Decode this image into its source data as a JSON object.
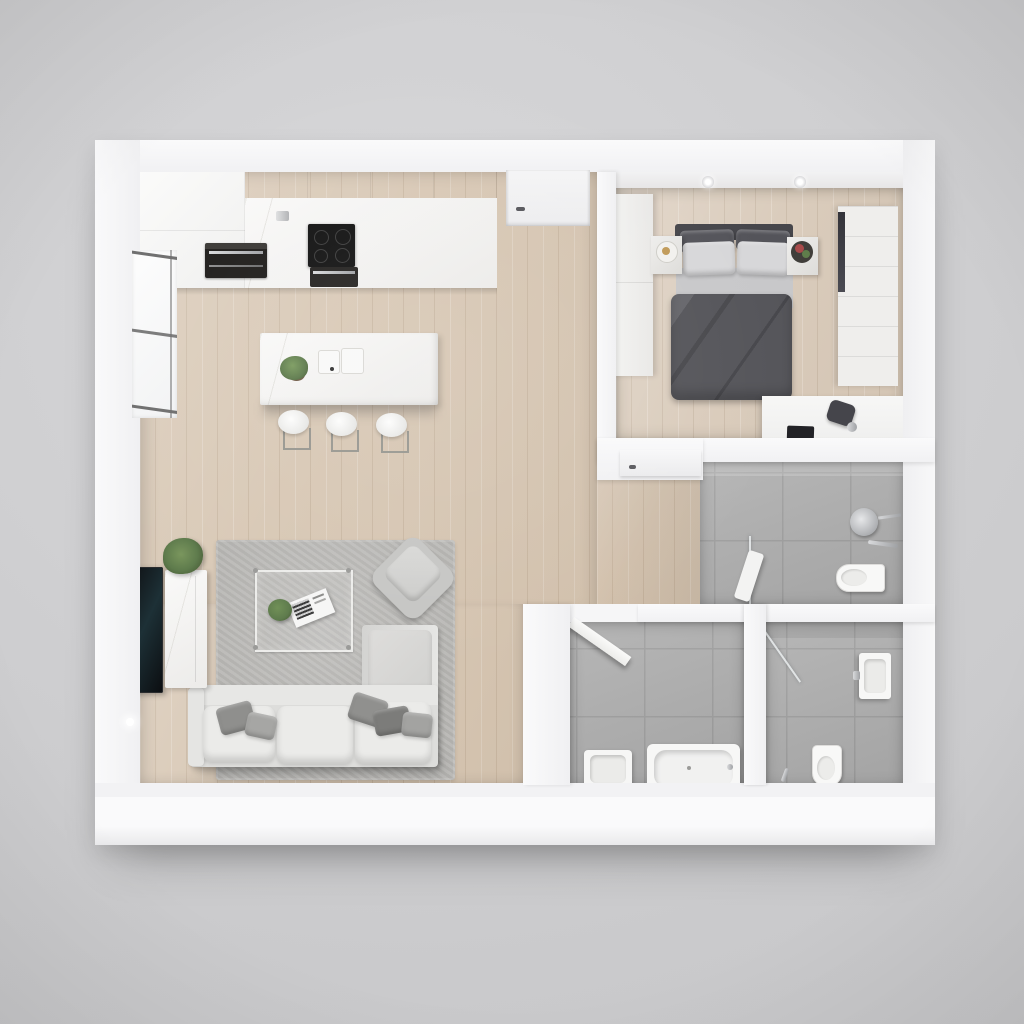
{
  "meta": {
    "type": "3d-floorplan-render",
    "view": "top-down",
    "canvas": {
      "width": 1024,
      "height": 1024
    },
    "description": "Photorealistic top-down 3D render of a one-bedroom apartment floor plan with open kitchen-living room, bedroom and three bathrooms on grey backdrop"
  },
  "palette": {
    "bg1": "#d7d7d9",
    "bg2": "#c6c6c8",
    "wall": "#f6f6f7",
    "wallBright": "#fafafb",
    "wood": "#d8c8b5",
    "woodDark": "#cfbda8",
    "tile": "#aeaeae",
    "grout": "#9e9e9e",
    "rug": "#b8b7b4",
    "marble": "#f4f3f1",
    "sofa": "#dddddb",
    "cushion": "#ebebe9",
    "duvet": "#55555a",
    "linen": "#c8c8ca",
    "pillowlight": "#d7d7d9",
    "dark": "#2a2a2e",
    "chromec": "#b9babc",
    "green": "#5d7a4b",
    "pot": "#6d5843"
  },
  "rooms": [
    {
      "label": "Open kitchen and living room",
      "items": [
        "tall cabinet block with built-in oven",
        "upper cabinets",
        "marble counter with induction cooktop and oven",
        "cooker hood",
        "entry door",
        "window",
        "kitchen island with double sink, faucet and plant",
        "three bar stools",
        "wall-mounted TV",
        "marble media console",
        "potted plant",
        "grey area rug",
        "glass coffee table with books and small plant",
        "lounge armchair",
        "L-shaped sofa with grey throw pillows",
        "wall light"
      ]
    },
    {
      "label": "Bedroom",
      "items": [
        "built-in wardrobe",
        "double bed with dark grey duvet and light pillows",
        "left nightstand with tray decor",
        "right nightstand with flowers",
        "chest of drawers with mirror strip",
        "desk with laptop and chair",
        "two ceiling spotlights",
        "door to hallway"
      ]
    },
    {
      "label": "Shower room",
      "items": [
        "rain shower head",
        "shower mixer",
        "glass screen",
        "wall-hung toilet",
        "leaning towel"
      ]
    },
    {
      "label": "Bathroom with bathtub",
      "items": [
        "open door",
        "washbasin with faucet",
        "bathtub"
      ]
    },
    {
      "label": "Shower bathroom",
      "items": [
        "corner glass shower screen",
        "shower mixer",
        "wall-hung washbasin",
        "toilet",
        "toilet brush"
      ]
    }
  ]
}
